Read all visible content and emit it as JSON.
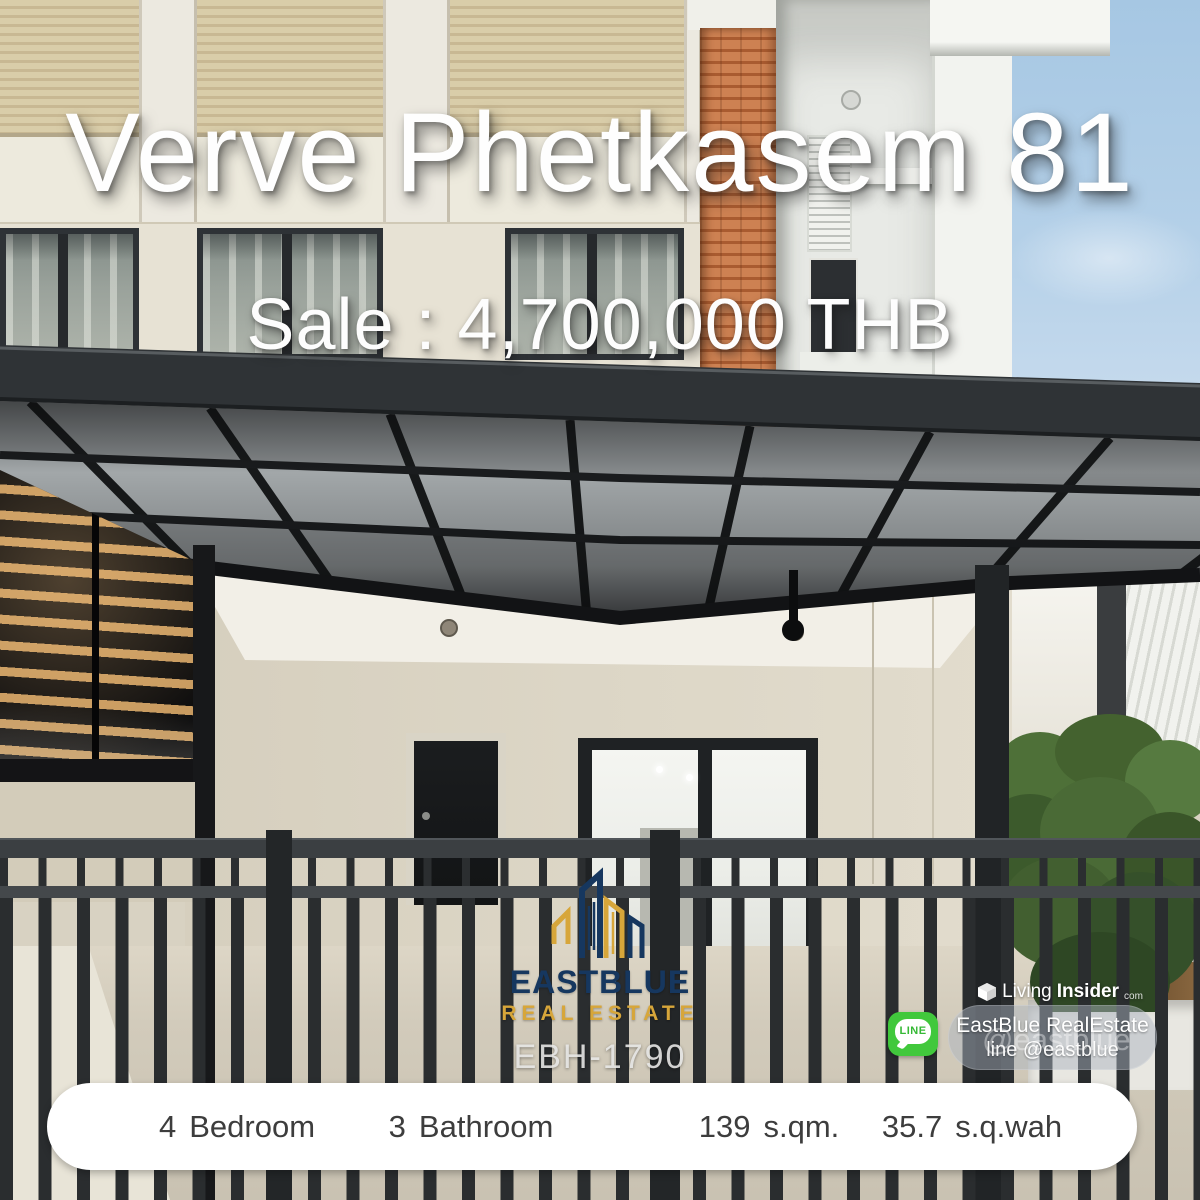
{
  "listing": {
    "title": "Verve Phetkasem 81",
    "price": "Sale : 4,700,000 THB",
    "code": "EBH-1790"
  },
  "brand": {
    "name": "EASTBLUE",
    "tagline": "REAL ESTATE",
    "icon": "buildings-skyline-line-art",
    "color_navy": "#16375F",
    "color_gold": "#D7A63A"
  },
  "badges": {
    "line": {
      "label": "LINE",
      "color": "#41C83C"
    },
    "living_insider": {
      "part1": "Living",
      "part2": "Insider",
      "suffix": "com"
    },
    "contact": {
      "line1": "EastBlue RealEstate",
      "line2": "line @eastblue",
      "watermark": "@eastblue"
    }
  },
  "stats": {
    "items": [
      {
        "value": "4",
        "unit": "Bedroom"
      },
      {
        "value": "3",
        "unit": "Bathroom"
      },
      {
        "value": "139",
        "unit": "s.qm."
      },
      {
        "value": "35.7",
        "unit": "s.q.wah"
      }
    ]
  }
}
